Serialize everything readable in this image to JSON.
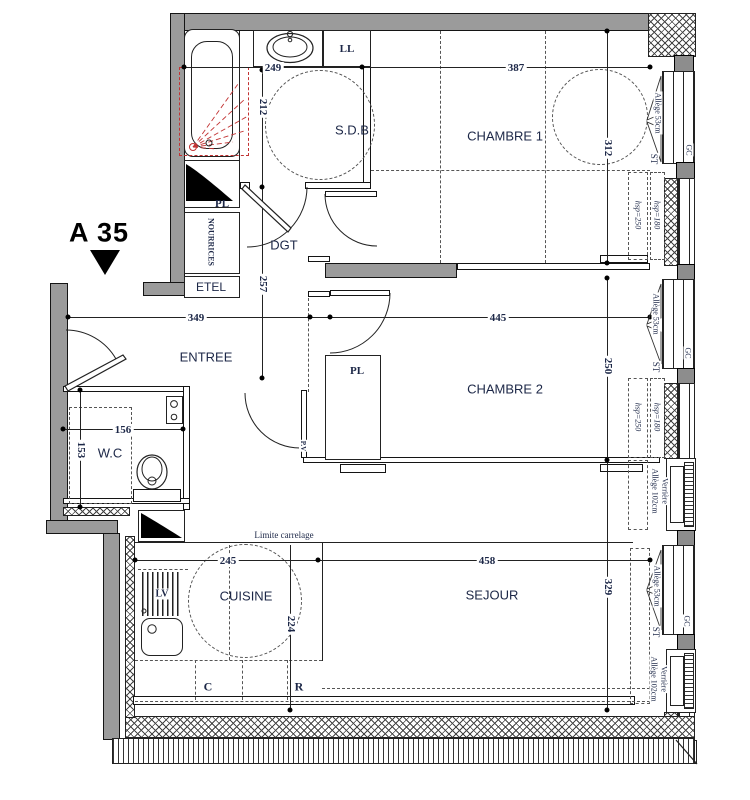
{
  "plan": {
    "apartment_label": "A 35",
    "rooms": {
      "sdb": "S.D.B",
      "chambre1": "CHAMBRE 1",
      "chambre2": "CHAMBRE 2",
      "entree": "ENTREE",
      "wc": "W.C",
      "cuisine": "CUISINE",
      "sejour": "SEJOUR",
      "dgt": "DGT"
    },
    "fixtures": {
      "ll": "LL",
      "pl_bath": "PL",
      "nourrices": "NOURRICES",
      "etel": "ETEL",
      "pl_bedroom": "PL",
      "glazed_door": "P.V",
      "dishwasher": "LV",
      "hob": "C",
      "fridge": "R"
    },
    "dimensions_cm": {
      "bath_width": "249",
      "bath_depth": "212",
      "hall_depth": "257",
      "entry_width": "349",
      "bedroom1_width": "387",
      "bedroom1_depth": "312",
      "bedroom2_width": "445",
      "bedroom2_depth": "250",
      "wc_width": "156",
      "wc_depth": "153",
      "kitchen_width": "245",
      "kitchen_depth": "224",
      "living_width": "458",
      "living_depth": "329"
    },
    "annotations": {
      "tile_limit": "Limite carrelage",
      "sill_53": "Allège 53cm",
      "sill_102": "Allège 102cm",
      "glass_roof": "Verrière",
      "st": "ST",
      "gc": "GC",
      "ceiling_180": "hsp=180",
      "ceiling_250": "hsp=250"
    }
  }
}
